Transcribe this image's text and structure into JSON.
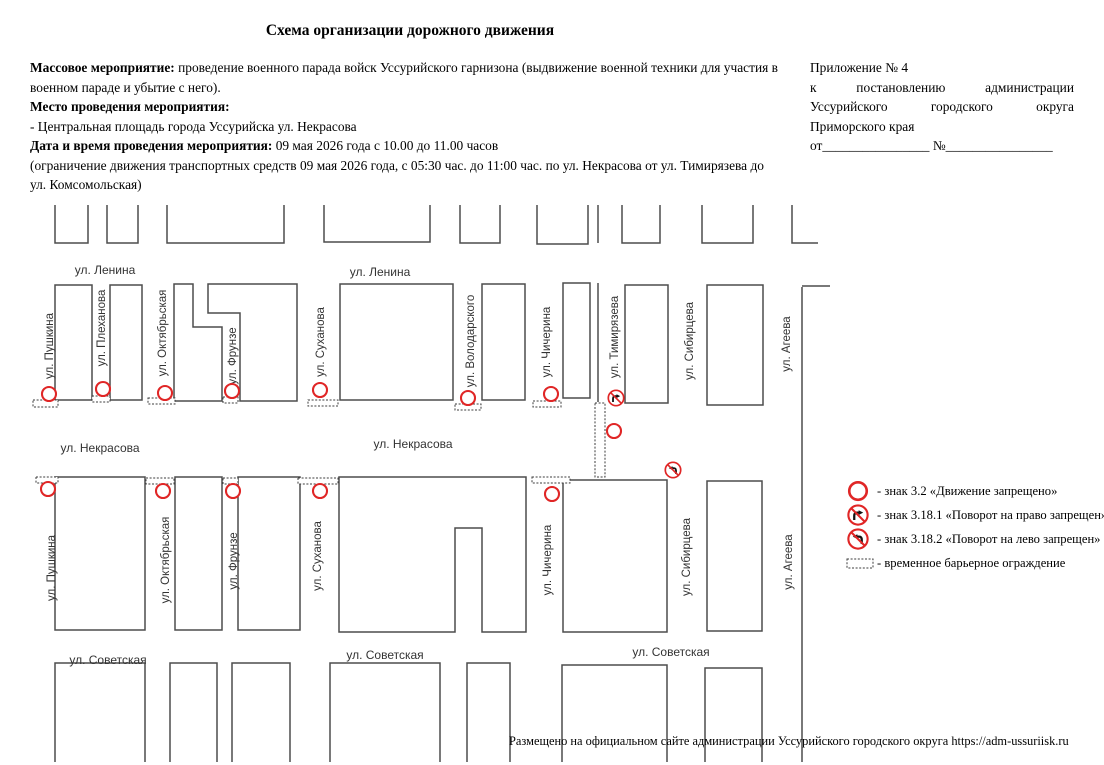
{
  "title": "Схема организации дорожного движения",
  "info": {
    "lines": [
      {
        "segments": [
          {
            "b": true,
            "t": "Массовое мероприятие:"
          },
          {
            "b": false,
            "t": " проведение военного парада войск Уссурийского гарнизона (выдвижение военной техники для участия в военном параде и убытие с него)."
          }
        ]
      },
      {
        "segments": [
          {
            "b": true,
            "t": "Место проведения мероприятия:"
          }
        ]
      },
      {
        "segments": [
          {
            "b": false,
            "t": "- Центральная площадь города Уссурийска ул. Некрасова"
          }
        ]
      },
      {
        "segments": [
          {
            "b": true,
            "t": "Дата и время проведения мероприятия:"
          },
          {
            "b": false,
            "t": " 09 мая 2026 года с 10.00 до 11.00 часов"
          }
        ]
      },
      {
        "segments": [
          {
            "b": false,
            "t": "(ограничение движения транспортных средств 09 мая 2026 года, с 05:30 час. до 11:00 час. по ул. Некрасова от ул. Тимирязева до ул. Комсомольская)"
          }
        ]
      }
    ]
  },
  "annex": {
    "lines": [
      "Приложение № 4",
      "к постановлению администрации",
      "Уссурийского городского округа",
      "Приморского края",
      "от________________ №________________"
    ],
    "justified_lines": [
      1,
      2
    ]
  },
  "colors": {
    "sign_red": "#e02626",
    "line_gray": "#4d4d4d",
    "label_gray": "#333333"
  },
  "map": {
    "blocks": [
      {
        "d": "M55 205 V243 H88 V205"
      },
      {
        "d": "M107 205 V243 H138 V205"
      },
      {
        "d": "M167 205 V243 H284 V205"
      },
      {
        "d": "M324 205 V242 H430 V205"
      },
      {
        "d": "M460 205 V243 H500 V205"
      },
      {
        "d": "M537 205 V244 H588 V205"
      },
      {
        "d": "M622 205 V243 H660 V205"
      },
      {
        "d": "M702 205 V243 H753 V205"
      },
      {
        "d": "M792 205 V243 H818"
      },
      {
        "d": "M55 285 H92 V400 H55 Z"
      },
      {
        "d": "M110 285 H142 V400 H110 Z"
      },
      {
        "d": "M174 284 H193 V327 H222 V401 H174 Z"
      },
      {
        "d": "M208 284 H297 V401 H240 V313 H208 Z"
      },
      {
        "d": "M340 284 H453 V400 H340 Z"
      },
      {
        "d": "M482 284 H525 V400 H482 Z"
      },
      {
        "d": "M563 283 H590 V398 H563 Z"
      },
      {
        "d": "M625 285 H668 V403 H625 Z"
      },
      {
        "d": "M707 285 H763 V405 H707 Z"
      },
      {
        "d": "M55 477 H145 V630 H55 Z"
      },
      {
        "d": "M175 477 H222 V630 H175 Z"
      },
      {
        "d": "M238 477 H300 V630 H238 Z"
      },
      {
        "d": "M339 477 H526 V632 H482 V528 H455 V632 H339 Z"
      },
      {
        "d": "M563 480 H667 V632 H563 Z"
      },
      {
        "d": "M707 481 H762 V631 H707 Z"
      },
      {
        "d": "M55 762 V663 H145 V762"
      },
      {
        "d": "M170 762 V663 H217 V762"
      },
      {
        "d": "M232 762 V663 H290 V762"
      },
      {
        "d": "M330 762 V663 H440 V762"
      },
      {
        "d": "M467 762 V663 H510 V762"
      },
      {
        "d": "M562 762 V665 H667 V762"
      },
      {
        "d": "M705 762 V668 H762 V762"
      }
    ],
    "lines": [
      {
        "x1": 598,
        "y1": 205,
        "x2": 598,
        "y2": 243
      },
      {
        "x1": 598,
        "y1": 283,
        "x2": 598,
        "y2": 402
      },
      {
        "x1": 802,
        "y1": 286,
        "x2": 830,
        "y2": 286
      },
      {
        "x1": 802,
        "y1": 287,
        "x2": 802,
        "y2": 762
      }
    ],
    "labels": [
      {
        "t": "ул. Ленина",
        "x": 105,
        "y": 270
      },
      {
        "t": "ул. Ленина",
        "x": 380,
        "y": 272
      },
      {
        "t": "ул. Некрасова",
        "x": 100,
        "y": 448
      },
      {
        "t": "ул. Некрасова",
        "x": 413,
        "y": 444
      },
      {
        "t": "ул. Советская",
        "x": 108,
        "y": 660
      },
      {
        "t": "ул. Советская",
        "x": 385,
        "y": 655
      },
      {
        "t": "ул. Советская",
        "x": 671,
        "y": 652
      },
      {
        "t": "ул. Пушкина",
        "x": 49,
        "y": 346,
        "r": -90
      },
      {
        "t": "ул. Плеханова",
        "x": 101,
        "y": 328,
        "r": -90
      },
      {
        "t": "ул. Октябрьская",
        "x": 162,
        "y": 333,
        "r": -90
      },
      {
        "t": "ул. Фрунзе",
        "x": 232,
        "y": 356,
        "r": -90
      },
      {
        "t": "ул. Суханова",
        "x": 320,
        "y": 342,
        "r": -90
      },
      {
        "t": "ул. Володарского",
        "x": 470,
        "y": 341,
        "r": -90
      },
      {
        "t": "ул. Чичерина",
        "x": 546,
        "y": 342,
        "r": -90
      },
      {
        "t": "ул. Тимирязева",
        "x": 614,
        "y": 337,
        "r": -90
      },
      {
        "t": "ул. Сибирцева",
        "x": 689,
        "y": 341,
        "r": -90
      },
      {
        "t": "ул. Агеева",
        "x": 786,
        "y": 344,
        "r": -90
      },
      {
        "t": "ул. Пушкина",
        "x": 51,
        "y": 568,
        "r": -90
      },
      {
        "t": "ул. Октябрьская",
        "x": 165,
        "y": 560,
        "r": -90
      },
      {
        "t": "ул. Фрунзе",
        "x": 233,
        "y": 561,
        "r": -90
      },
      {
        "t": "ул. Суханова",
        "x": 317,
        "y": 556,
        "r": -90
      },
      {
        "t": "ул. Чичерина",
        "x": 547,
        "y": 560,
        "r": -90
      },
      {
        "t": "ул. Сибирцева",
        "x": 686,
        "y": 557,
        "r": -90
      },
      {
        "t": "ул. Агеева",
        "x": 788,
        "y": 562,
        "r": -90
      }
    ],
    "barriers": [
      {
        "x": 33,
        "y": 400,
        "w": 25,
        "h": 7
      },
      {
        "x": 92,
        "y": 396,
        "w": 18,
        "h": 6
      },
      {
        "x": 148,
        "y": 398,
        "w": 27,
        "h": 6
      },
      {
        "x": 223,
        "y": 397,
        "w": 15,
        "h": 6
      },
      {
        "x": 308,
        "y": 400,
        "w": 30,
        "h": 6
      },
      {
        "x": 455,
        "y": 404,
        "w": 26,
        "h": 6
      },
      {
        "x": 533,
        "y": 401,
        "w": 28,
        "h": 6
      },
      {
        "x": 595,
        "y": 403,
        "w": 10,
        "h": 74
      },
      {
        "x": 36,
        "y": 477,
        "w": 22,
        "h": 6
      },
      {
        "x": 146,
        "y": 478,
        "w": 28,
        "h": 6
      },
      {
        "x": 223,
        "y": 478,
        "w": 15,
        "h": 6
      },
      {
        "x": 298,
        "y": 478,
        "w": 40,
        "h": 6
      },
      {
        "x": 532,
        "y": 477,
        "w": 38,
        "h": 6
      }
    ],
    "signs": [
      {
        "kind": "3.2",
        "x": 49,
        "y": 394
      },
      {
        "kind": "3.2",
        "x": 103,
        "y": 389
      },
      {
        "kind": "3.2",
        "x": 165,
        "y": 393
      },
      {
        "kind": "3.2",
        "x": 232,
        "y": 391
      },
      {
        "kind": "3.2",
        "x": 320,
        "y": 390
      },
      {
        "kind": "3.2",
        "x": 468,
        "y": 398
      },
      {
        "kind": "3.2",
        "x": 551,
        "y": 394
      },
      {
        "kind": "3.18.1",
        "x": 616,
        "y": 398
      },
      {
        "kind": "3.2",
        "x": 614,
        "y": 431
      },
      {
        "kind": "3.18.2",
        "x": 673,
        "y": 470
      },
      {
        "kind": "3.2",
        "x": 48,
        "y": 489
      },
      {
        "kind": "3.2",
        "x": 163,
        "y": 491
      },
      {
        "kind": "3.2",
        "x": 233,
        "y": 491
      },
      {
        "kind": "3.2",
        "x": 320,
        "y": 491
      },
      {
        "kind": "3.2",
        "x": 552,
        "y": 494
      }
    ]
  },
  "legend": {
    "items": [
      {
        "kind": "sign-3.2",
        "label": "- знак 3.2 «Движение запрещено»"
      },
      {
        "kind": "sign-3.18.1",
        "label": "- знак 3.18.1 «Поворот на право запрещен»"
      },
      {
        "kind": "sign-3.18.2",
        "label": "- знак 3.18.2 «Поворот на лево запрещен»"
      },
      {
        "kind": "barrier",
        "label": "- временное барьерное ограждение"
      }
    ]
  },
  "footer": "Размещено на официальном сайте администрации Уссурийского городского округа https://adm-ussuriisk.ru"
}
